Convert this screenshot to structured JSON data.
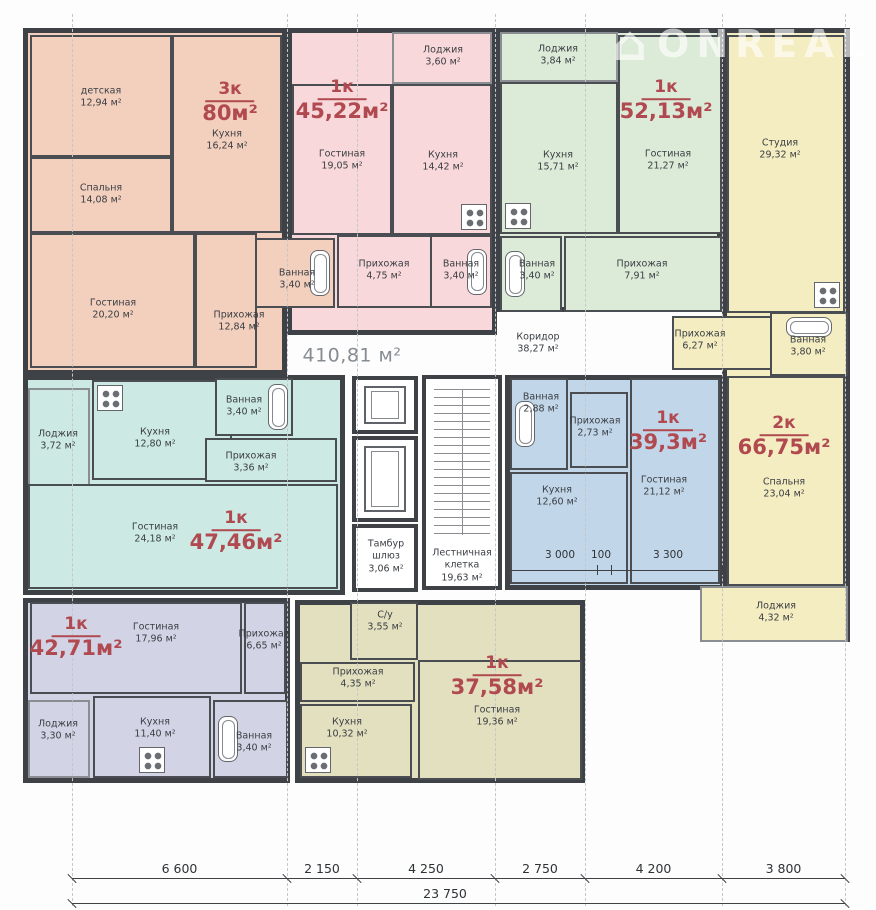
{
  "watermark": {
    "icon_glyph": "⌂",
    "text": "ONREAL",
    "color": "rgba(255,255,255,0.62)"
  },
  "floorplan": {
    "grid_x": [
      72,
      287,
      357,
      495,
      585,
      722,
      845
    ],
    "apartments": [
      {
        "key": "3k-80",
        "type": "3к",
        "area": "80м²",
        "color": "#f3cfbe",
        "rect": {
          "x": 23,
          "y": 28,
          "w": 264,
          "h": 347
        },
        "label": {
          "x": 230,
          "y": 103
        },
        "rooms": [
          {
            "key": "nursery",
            "name": "детская",
            "area": "12,94 м²",
            "rect": {
              "x": 30,
              "y": 35,
              "w": 142,
              "h": 122
            },
            "label": {
              "x": 101,
              "y": 98
            }
          },
          {
            "key": "bedroom",
            "name": "Спальня",
            "area": "14,08 м²",
            "rect": {
              "x": 30,
              "y": 157,
              "w": 142,
              "h": 76
            },
            "label": {
              "x": 101,
              "y": 195
            }
          },
          {
            "key": "kitchen",
            "name": "Кухня",
            "area": "16,24 м²",
            "rect": {
              "x": 172,
              "y": 35,
              "w": 110,
              "h": 198
            },
            "label": {
              "x": 227,
              "y": 141
            }
          },
          {
            "key": "living",
            "name": "Гостиная",
            "area": "20,20 м²",
            "rect": {
              "x": 30,
              "y": 233,
              "w": 165,
              "h": 135
            },
            "label": {
              "x": 113,
              "y": 310
            }
          },
          {
            "key": "hall",
            "name": "Прихожая",
            "area": "12,84 м²",
            "rect": {
              "x": 195,
              "y": 233,
              "w": 62,
              "h": 135
            },
            "label": {
              "x": 239,
              "y": 322
            }
          },
          {
            "key": "bath",
            "name": "Ванная",
            "area": "3,40 м²",
            "rect": {
              "x": 255,
              "y": 238,
              "w": 80,
              "h": 70
            },
            "label": {
              "x": 297,
              "y": 280
            },
            "fixture": "tub",
            "orient": "v",
            "anchor": "r"
          }
        ]
      },
      {
        "key": "1k-45",
        "type": "1к",
        "area": "45,22м²",
        "color": "#f8d8da",
        "rect": {
          "x": 287,
          "y": 28,
          "w": 210,
          "h": 307
        },
        "label": {
          "x": 342,
          "y": 101
        },
        "rooms": [
          {
            "key": "loggia",
            "name": "Лоджия",
            "area": "3,60 м²",
            "rect": {
              "x": 392,
              "y": 32,
              "w": 100,
              "h": 52
            },
            "label": {
              "x": 443,
              "y": 57
            }
          },
          {
            "key": "living",
            "name": "Гостиная",
            "area": "19,05 м²",
            "rect": {
              "x": 292,
              "y": 84,
              "w": 100,
              "h": 151
            },
            "label": {
              "x": 342,
              "y": 161
            }
          },
          {
            "key": "kitchen",
            "name": "Кухня",
            "area": "14,42 м²",
            "rect": {
              "x": 392,
              "y": 84,
              "w": 100,
              "h": 151
            },
            "label": {
              "x": 443,
              "y": 162
            },
            "fixture": "stove",
            "anchor": "br"
          },
          {
            "key": "hall",
            "name": "Прихожая",
            "area": "4,75 м²",
            "rect": {
              "x": 337,
              "y": 235,
              "w": 95,
              "h": 73
            },
            "label": {
              "x": 384,
              "y": 271
            }
          },
          {
            "key": "bath",
            "name": "Ванная",
            "area": "3,40 м²",
            "rect": {
              "x": 430,
              "y": 235,
              "w": 62,
              "h": 73
            },
            "label": {
              "x": 461,
              "y": 271
            },
            "fixture": "tub",
            "orient": "v",
            "anchor": "r"
          }
        ]
      },
      {
        "key": "1k-52",
        "type": "1к",
        "area": "52,13м²",
        "color": "#dcead8",
        "rect": {
          "x": 495,
          "y": 28,
          "w": 227,
          "h": 284
        },
        "label": {
          "x": 666,
          "y": 101
        },
        "rooms": [
          {
            "key": "loggia",
            "name": "Лоджия",
            "area": "3,84 м²",
            "rect": {
              "x": 500,
              "y": 32,
              "w": 118,
              "h": 50
            },
            "label": {
              "x": 558,
              "y": 56
            }
          },
          {
            "key": "kitchen",
            "name": "Кухня",
            "area": "15,71 м²",
            "rect": {
              "x": 500,
              "y": 82,
              "w": 118,
              "h": 152
            },
            "label": {
              "x": 558,
              "y": 162
            },
            "fixture": "stove",
            "anchor": "bl"
          },
          {
            "key": "living",
            "name": "Гостиная",
            "area": "21,27 м²",
            "rect": {
              "x": 618,
              "y": 35,
              "w": 104,
              "h": 199
            },
            "label": {
              "x": 668,
              "y": 161
            }
          },
          {
            "key": "bath",
            "name": "Ванная",
            "area": "3,40 м²",
            "rect": {
              "x": 500,
              "y": 236,
              "w": 62,
              "h": 76
            },
            "label": {
              "x": 537,
              "y": 271
            },
            "fixture": "tub",
            "orient": "v",
            "anchor": "l"
          },
          {
            "key": "hall",
            "name": "Прихожая",
            "area": "7,91 м²",
            "rect": {
              "x": 564,
              "y": 236,
              "w": 158,
              "h": 76
            },
            "label": {
              "x": 642,
              "y": 271
            }
          }
        ]
      },
      {
        "key": "2k-66",
        "type": "2к",
        "area": "66,75м²",
        "color": "#f4edc1",
        "rect": {
          "x": 722,
          "y": 28,
          "w": 128,
          "h": 614
        },
        "label": {
          "x": 784,
          "y": 437
        },
        "rooms": [
          {
            "key": "studio",
            "name": "Студия",
            "area": "29,32 м²",
            "rect": {
              "x": 727,
              "y": 35,
              "w": 118,
              "h": 278
            },
            "label": {
              "x": 780,
              "y": 150
            },
            "fixture": "stove",
            "anchor": "br"
          },
          {
            "key": "hall",
            "name": "Прихожая",
            "area": "6,27 м²",
            "rect": {
              "x": 672,
              "y": 316,
              "w": 100,
              "h": 54
            },
            "label": {
              "x": 700,
              "y": 341
            }
          },
          {
            "key": "bath",
            "name": "Ванная",
            "area": "3,80 м²",
            "rect": {
              "x": 770,
              "y": 312,
              "w": 78,
              "h": 64
            },
            "label": {
              "x": 808,
              "y": 347
            },
            "fixture": "tub",
            "orient": "h",
            "anchor": "t"
          },
          {
            "key": "bedroom",
            "name": "Спальня",
            "area": "23,04 м²",
            "rect": {
              "x": 727,
              "y": 376,
              "w": 118,
              "h": 210
            },
            "label": {
              "x": 784,
              "y": 489
            }
          },
          {
            "key": "loggia",
            "name": "Лоджия",
            "area": "4,32 м²",
            "rect": {
              "x": 700,
              "y": 586,
              "w": 148,
              "h": 56
            },
            "label": {
              "x": 776,
              "y": 613
            }
          }
        ]
      },
      {
        "key": "1k-47",
        "type": "1к",
        "area": "47,46м²",
        "color": "#cde9e4",
        "rect": {
          "x": 23,
          "y": 375,
          "w": 322,
          "h": 220
        },
        "label": {
          "x": 236,
          "y": 532
        },
        "rooms": [
          {
            "key": "loggia",
            "name": "Лоджия",
            "area": "3,72 м²",
            "rect": {
              "x": 28,
              "y": 388,
              "w": 62,
              "h": 145
            },
            "label": {
              "x": 58,
              "y": 441
            }
          },
          {
            "key": "kitchen",
            "name": "Кухня",
            "area": "12,80 м²",
            "rect": {
              "x": 92,
              "y": 380,
              "w": 140,
              "h": 100
            },
            "label": {
              "x": 155,
              "y": 439
            },
            "fixture": "stove",
            "anchor": "tl"
          },
          {
            "key": "bath",
            "name": "Ванная",
            "area": "3,40 м²",
            "rect": {
              "x": 215,
              "y": 378,
              "w": 78,
              "h": 58
            },
            "label": {
              "x": 244,
              "y": 407
            },
            "fixture": "tub",
            "orient": "v",
            "anchor": "r"
          },
          {
            "key": "hall",
            "name": "Прихожая",
            "area": "3,36 м²",
            "rect": {
              "x": 205,
              "y": 438,
              "w": 132,
              "h": 44
            },
            "label": {
              "x": 251,
              "y": 463
            }
          },
          {
            "key": "living",
            "name": "Гостиная",
            "area": "24,18 м²",
            "rect": {
              "x": 28,
              "y": 484,
              "w": 310,
              "h": 105
            },
            "label": {
              "x": 155,
              "y": 534
            }
          }
        ]
      },
      {
        "key": "1k-39",
        "type": "1к",
        "area": "39,3м²",
        "color": "#c2d6e9",
        "rect": {
          "x": 505,
          "y": 375,
          "w": 220,
          "h": 215
        },
        "label": {
          "x": 668,
          "y": 432
        },
        "inner_dims": {
          "labels": [
            "3 000",
            "100",
            "3 300"
          ],
          "xs": [
            560,
            601,
            668
          ],
          "y": 549,
          "line": {
            "x1": 508,
            "x2": 722,
            "y": 570,
            "ticks": [
              508,
              597,
              611,
              722
            ]
          }
        },
        "rooms": [
          {
            "key": "bath",
            "name": "Ванная",
            "area": "2,88 м²",
            "rect": {
              "x": 510,
              "y": 378,
              "w": 58,
              "h": 92
            },
            "label": {
              "x": 541,
              "y": 404
            },
            "fixture": "tub",
            "orient": "v",
            "anchor": "l"
          },
          {
            "key": "hall",
            "name": "Прихожая",
            "area": "2,73 м²",
            "rect": {
              "x": 570,
              "y": 392,
              "w": 58,
              "h": 76
            },
            "label": {
              "x": 595,
              "y": 428
            }
          },
          {
            "key": "kitchen",
            "name": "Кухня",
            "area": "12,60 м²",
            "rect": {
              "x": 510,
              "y": 472,
              "w": 118,
              "h": 112
            },
            "label": {
              "x": 557,
              "y": 497
            }
          },
          {
            "key": "living",
            "name": "Гостиная",
            "area": "21,12 м²",
            "rect": {
              "x": 630,
              "y": 378,
              "w": 90,
              "h": 206
            },
            "label": {
              "x": 664,
              "y": 487
            }
          }
        ]
      },
      {
        "key": "1k-42",
        "type": "1к",
        "area": "42,71м²",
        "color": "#d2d4e5",
        "rect": {
          "x": 23,
          "y": 598,
          "w": 267,
          "h": 185
        },
        "label": {
          "x": 76,
          "y": 638
        },
        "rooms": [
          {
            "key": "living",
            "name": "Гостиная",
            "area": "17,96 м²",
            "rect": {
              "x": 30,
              "y": 602,
              "w": 212,
              "h": 92
            },
            "label": {
              "x": 156,
              "y": 634
            }
          },
          {
            "key": "hall",
            "name": "Прихожая",
            "area": "6,65 м²",
            "rect": {
              "x": 244,
              "y": 602,
              "w": 42,
              "h": 92
            },
            "label": {
              "x": 264,
              "y": 641
            }
          },
          {
            "key": "loggia",
            "name": "Лоджия",
            "area": "3,30 м²",
            "rect": {
              "x": 28,
              "y": 700,
              "w": 62,
              "h": 78
            },
            "label": {
              "x": 58,
              "y": 731
            }
          },
          {
            "key": "kitchen",
            "name": "Кухня",
            "area": "11,40 м²",
            "rect": {
              "x": 93,
              "y": 696,
              "w": 118,
              "h": 82
            },
            "label": {
              "x": 155,
              "y": 729
            },
            "fixture": "stove",
            "anchor": "b"
          },
          {
            "key": "bath",
            "name": "Ванная",
            "area": "3,40 м²",
            "rect": {
              "x": 213,
              "y": 700,
              "w": 75,
              "h": 78
            },
            "label": {
              "x": 254,
              "y": 743
            },
            "fixture": "tub",
            "orient": "v",
            "anchor": "l"
          }
        ]
      },
      {
        "key": "1k-37",
        "type": "1к",
        "area": "37,58м²",
        "color": "#e3e0bf",
        "rect": {
          "x": 295,
          "y": 600,
          "w": 290,
          "h": 183
        },
        "label": {
          "x": 497,
          "y": 677
        },
        "rooms": [
          {
            "key": "wc",
            "name": "С/у",
            "area": "3,55 м²",
            "rect": {
              "x": 350,
              "y": 602,
              "w": 68,
              "h": 58
            },
            "label": {
              "x": 385,
              "y": 622
            }
          },
          {
            "key": "hall",
            "name": "Прихожая",
            "area": "4,35 м²",
            "rect": {
              "x": 300,
              "y": 662,
              "w": 115,
              "h": 40
            },
            "label": {
              "x": 358,
              "y": 679
            }
          },
          {
            "key": "kitchen",
            "name": "Кухня",
            "area": "10,32 м²",
            "rect": {
              "x": 300,
              "y": 704,
              "w": 112,
              "h": 74
            },
            "label": {
              "x": 347,
              "y": 729
            },
            "fixture": "stove",
            "anchor": "bl"
          },
          {
            "key": "living",
            "name": "Гостиная",
            "area": "19,36 м²",
            "rect": {
              "x": 418,
              "y": 660,
              "w": 164,
              "h": 120
            },
            "label": {
              "x": 497,
              "y": 717
            }
          }
        ]
      },
      {
        "key": "corridor-total",
        "type": "",
        "area": "",
        "color": "#ffffff",
        "rect": {
          "x": 0,
          "y": 0,
          "w": 0,
          "h": 0
        },
        "label": {
          "x": -100,
          "y": -100
        },
        "rooms": []
      }
    ],
    "common_areas": [
      {
        "key": "floor-total",
        "name": "",
        "area": "410,81 м²",
        "label": {
          "x": 352,
          "y": 356
        },
        "style": "big"
      },
      {
        "key": "corridor",
        "name": "Коридор",
        "area": "38,27 м²",
        "label": {
          "x": 538,
          "y": 344
        }
      },
      {
        "key": "elevator-1",
        "rect": {
          "x": 352,
          "y": 376,
          "w": 66,
          "h": 58
        },
        "feature": "elevator"
      },
      {
        "key": "elevator-2",
        "rect": {
          "x": 352,
          "y": 436,
          "w": 66,
          "h": 86
        },
        "feature": "elevator"
      },
      {
        "key": "tambour",
        "name": "Тамбур шлюз",
        "area": "3,06 м²",
        "rect": {
          "x": 352,
          "y": 524,
          "w": 66,
          "h": 68
        },
        "label": {
          "x": 386,
          "y": 557
        },
        "style": "wrap"
      },
      {
        "key": "stairwell",
        "name": "Лестничная клетка",
        "area": "19,63 м²",
        "rect": {
          "x": 422,
          "y": 375,
          "w": 80,
          "h": 215
        },
        "feature": "stairs",
        "label": {
          "x": 462,
          "y": 566
        },
        "style": "wrap"
      }
    ],
    "dimensions": {
      "segments": [
        "6 600",
        "2 150",
        "4 250",
        "2 750",
        "4 200",
        "3 800"
      ],
      "total": "23 750",
      "total_x": 445,
      "y_segments": 878,
      "y_total": 903
    }
  }
}
